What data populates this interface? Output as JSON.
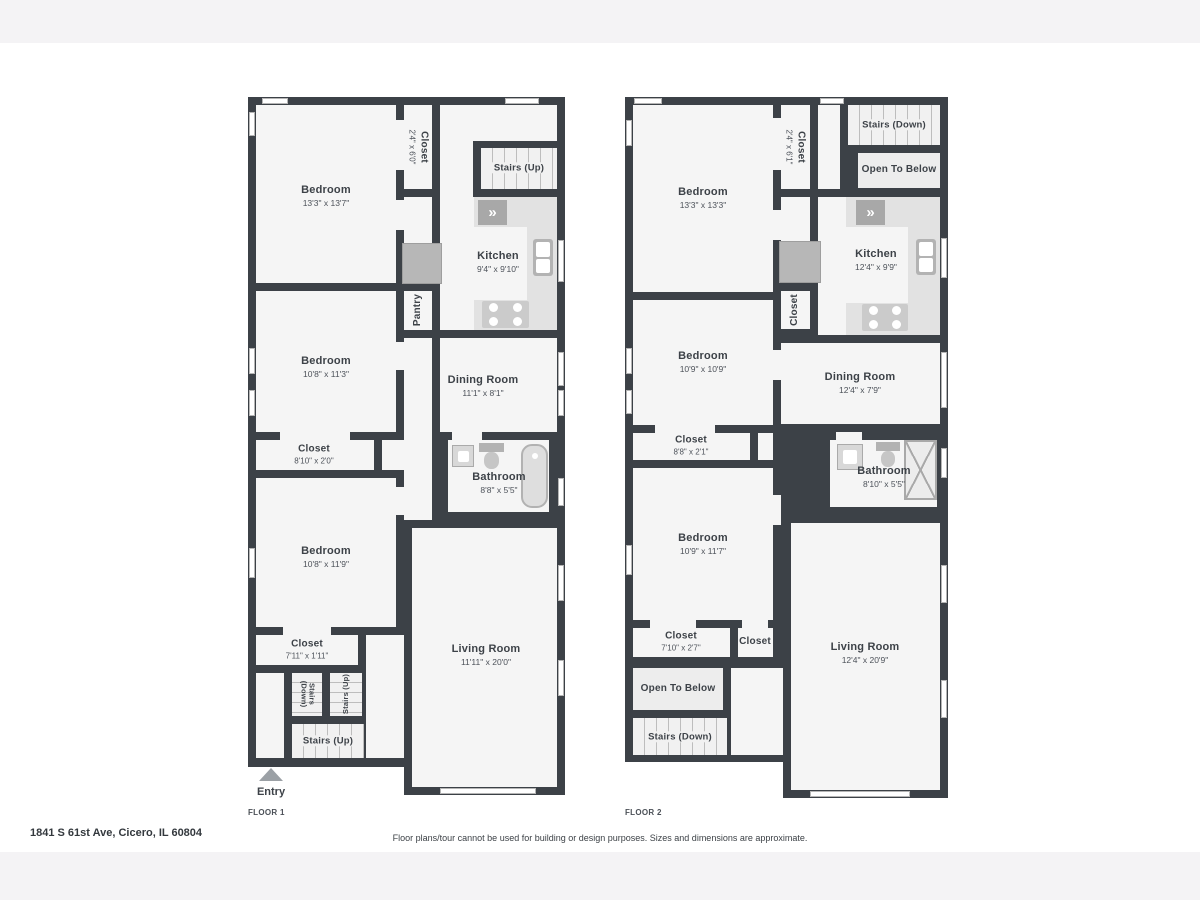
{
  "colors": {
    "wall": "#3c4147",
    "room": "#f5f5f5",
    "counter": "#e2e2e2",
    "stairs": "#f1f1f1",
    "fixture": "#bdbdbd",
    "entry_arrow": "#9ba0a5"
  },
  "icons": {
    "appliance_chevrons": "»"
  },
  "footer": {
    "address": "1841 S 61st Ave, Cicero, IL 60804",
    "disclaimer": "Floor plans/tour cannot be used for building or design purposes. Sizes and dimensions are approximate."
  },
  "floor1": {
    "label": "FLOOR 1",
    "entry": "Entry",
    "rooms": {
      "bedroom_top": {
        "name": "Bedroom",
        "dims": "13'3\" x 13'7\""
      },
      "closet_top": {
        "name": "Closet",
        "dims": "2'4\" x 6'0\""
      },
      "stairs_top": {
        "name": "Stairs (Up)"
      },
      "kitchen": {
        "name": "Kitchen",
        "dims": "9'4\" x 9'10\""
      },
      "pantry": {
        "name": "Pantry"
      },
      "bedroom_mid": {
        "name": "Bedroom",
        "dims": "10'8\" x 11'3\""
      },
      "dining": {
        "name": "Dining Room",
        "dims": "11'1\" x 8'1\""
      },
      "closet_mid": {
        "name": "Closet",
        "dims": "8'10\" x 2'0\""
      },
      "bathroom": {
        "name": "Bathroom",
        "dims": "8'8\" x 5'5\""
      },
      "bedroom_bottom": {
        "name": "Bedroom",
        "dims": "10'8\" x 11'9\""
      },
      "closet_bottom": {
        "name": "Closet",
        "dims": "7'11\" x 1'11\""
      },
      "living": {
        "name": "Living Room",
        "dims": "11'11\" x 20'0\""
      },
      "stairs_down_small": {
        "name": "Stairs (Down)"
      },
      "stairs_up_small": {
        "name": "Stairs (Up)"
      },
      "stairs_bottom": {
        "name": "Stairs (Up)"
      }
    }
  },
  "floor2": {
    "label": "FLOOR 2",
    "rooms": {
      "bedroom_top": {
        "name": "Bedroom",
        "dims": "13'3\" x 13'3\""
      },
      "closet_top": {
        "name": "Closet",
        "dims": "2'4\" x 6'1\""
      },
      "stairs_top": {
        "name": "Stairs (Down)"
      },
      "open_top": {
        "name": "Open To Below"
      },
      "kitchen": {
        "name": "Kitchen",
        "dims": "12'4\" x 9'9\""
      },
      "closet_kitchen": {
        "name": "Closet"
      },
      "bedroom_mid": {
        "name": "Bedroom",
        "dims": "10'9\" x 10'9\""
      },
      "dining": {
        "name": "Dining Room",
        "dims": "12'4\" x 7'9\""
      },
      "closet_mid": {
        "name": "Closet",
        "dims": "8'8\" x 2'1\""
      },
      "bathroom": {
        "name": "Bathroom",
        "dims": "8'10\" x 5'5\""
      },
      "bedroom_bottom": {
        "name": "Bedroom",
        "dims": "10'9\" x 11'7\""
      },
      "closet_bottom": {
        "name": "Closet",
        "dims": "7'10\" x 2'7\""
      },
      "closet_small": {
        "name": "Closet"
      },
      "living": {
        "name": "Living Room",
        "dims": "12'4\" x 20'9\""
      },
      "open_bottom": {
        "name": "Open To Below"
      },
      "stairs_bottom": {
        "name": "Stairs (Down)"
      }
    }
  }
}
